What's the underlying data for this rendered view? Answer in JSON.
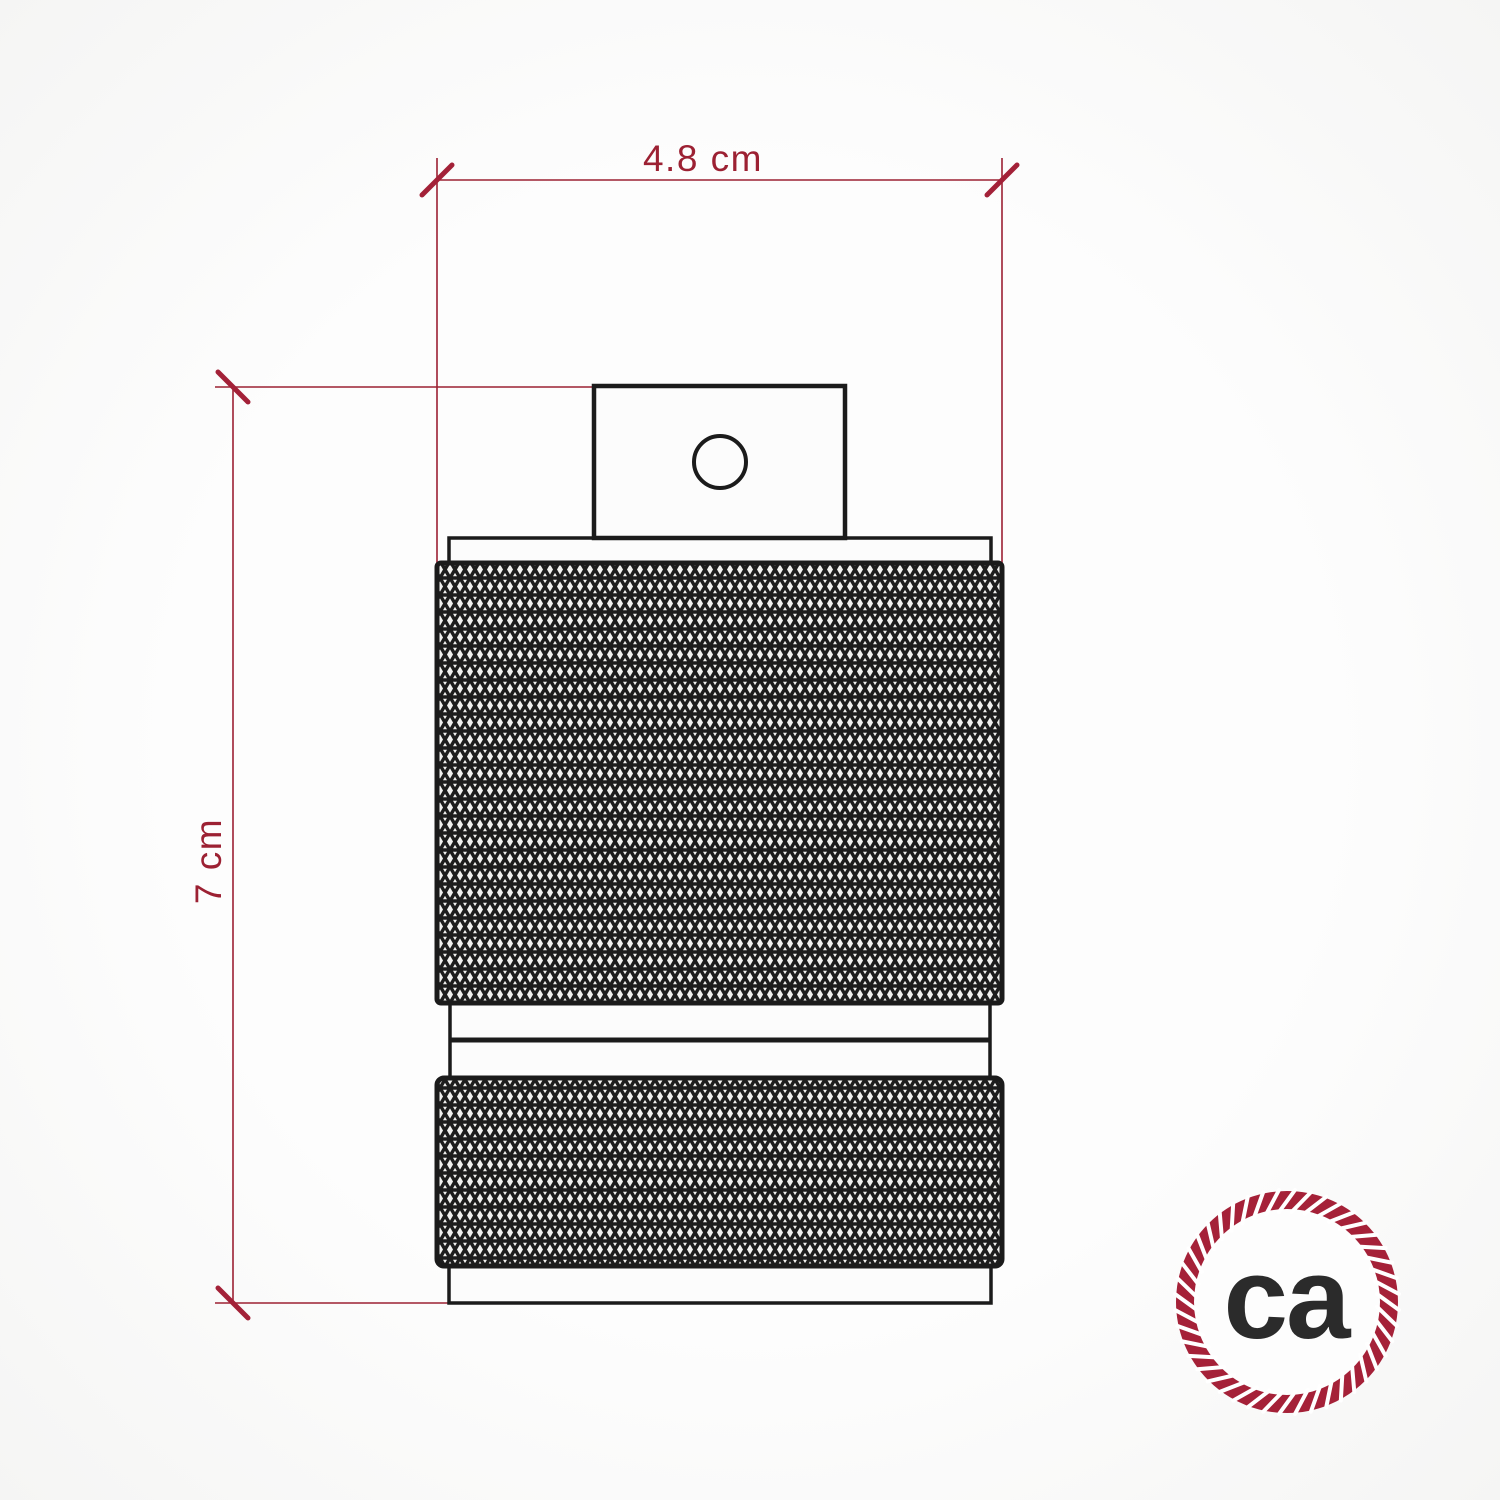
{
  "drawing": {
    "width_dimension": {
      "label": "4.8 cm"
    },
    "height_dimension": {
      "label": "7 cm"
    }
  },
  "logo": {
    "text": "ca"
  },
  "colors": {
    "dimension_line": "#9c2133",
    "dimension_tick": "#a32138",
    "dimension_text": "#9c2133",
    "product_outline": "#1b1b1b",
    "product_fill": "#fcfcfc",
    "knurl_background": "#f1f1ef",
    "knurl_line": "#1d1d1d",
    "logo_ring": "#a52138",
    "logo_text_color": "#2b2b2b"
  }
}
